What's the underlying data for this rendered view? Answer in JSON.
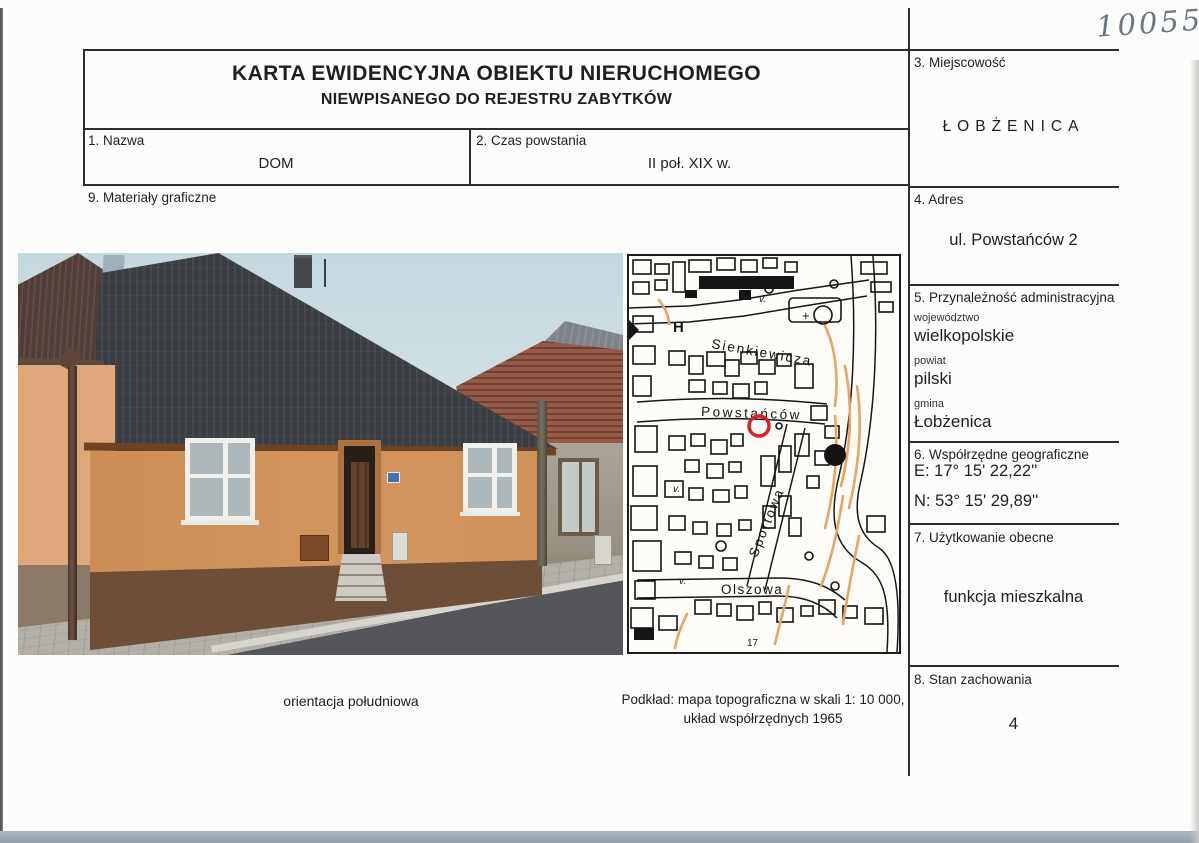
{
  "card": {
    "handwritten_number": "10055",
    "title_line1": "KARTA EWIDENCYJNA OBIEKTU NIERUCHOMEGO",
    "title_line2": "NIEWPISANEGO DO REJESTRU ZABYTKÓW"
  },
  "fields": {
    "nazwa": {
      "label": "1. Nazwa",
      "value": "DOM"
    },
    "czas_powstania": {
      "label": "2. Czas powstania",
      "value": "II poł. XIX w."
    },
    "miejscowosc": {
      "label": "3. Miejscowość",
      "value": "ŁOBŻENICA"
    },
    "adres": {
      "label": "4. Adres",
      "value": "ul. Powstańców 2"
    },
    "przynaleznosc": {
      "label": "5. Przynależność administracyjna",
      "wojewodztwo_label": "województwo",
      "wojewodztwo": "wielkopolskie",
      "powiat_label": "powiat",
      "powiat": "pilski",
      "gmina_label": "gmina",
      "gmina": "Łobżenica"
    },
    "wspolrzedne": {
      "label": "6. Współrzędne geograficzne",
      "e": "E: 17° 15' 22,22''",
      "n": "N: 53° 15' 29,89''"
    },
    "uzytkowanie": {
      "label": "7. Użytkowanie obecne",
      "value": "funkcja mieszkalna"
    },
    "stan": {
      "label": "8. Stan zachowania",
      "value": "4"
    },
    "materialy": {
      "label": "9. Materiały graficzne"
    }
  },
  "photo": {
    "caption": "orientacja południowa"
  },
  "map": {
    "caption_line1": "Podkład: mapa topograficzna w skali 1: 10 000,",
    "caption_line2": "układ współrzędnych 1965",
    "streets": {
      "sienkiewicza": "Sienkiewicza",
      "powstancow": "Powstańców",
      "sportowa": "Sportowa",
      "olszowa": "Olszowa"
    },
    "symbols": {
      "h": "H",
      "v": "v.",
      "plus": "+",
      "house_number": "17"
    },
    "marker_color": "#dd1f1f",
    "contour_color": "#eaa45e"
  }
}
